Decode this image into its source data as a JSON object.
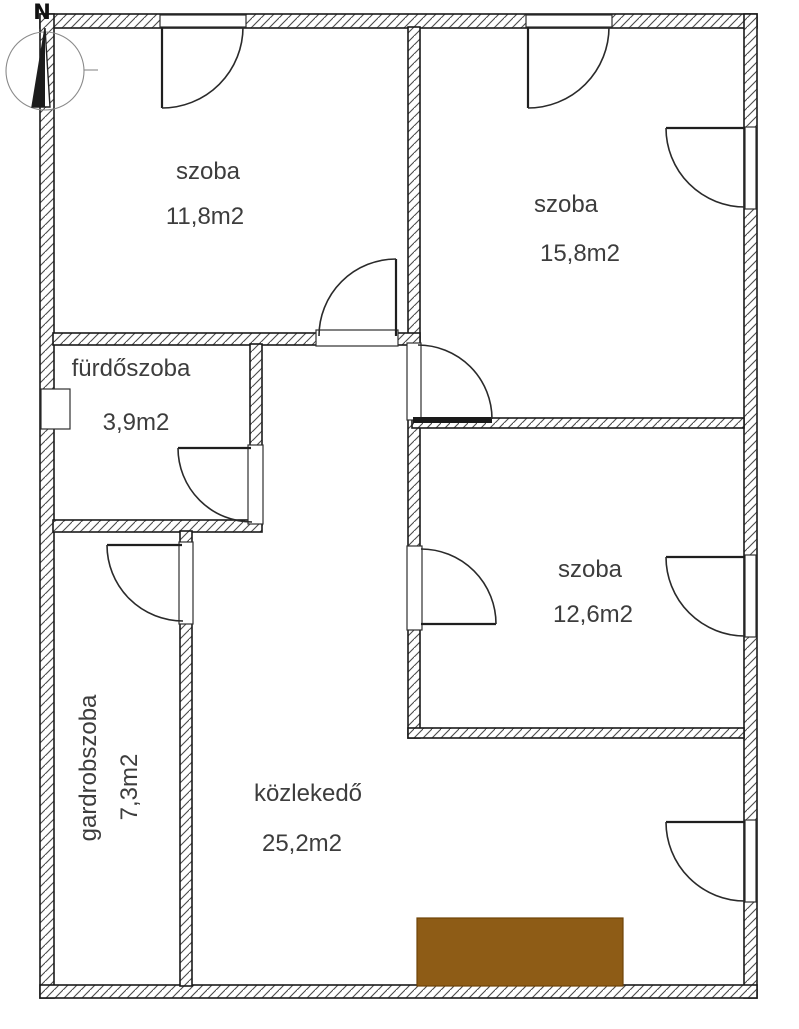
{
  "plan": {
    "compass": {
      "north_label": "N"
    },
    "rooms": [
      {
        "name": "szoba",
        "area": "11,8m2"
      },
      {
        "name": "szoba",
        "area": "15,8m2"
      },
      {
        "name": "fürdőszoba",
        "area": "3,9m2"
      },
      {
        "name": "szoba",
        "area": "12,6m2"
      },
      {
        "name": "gardrobszoba",
        "area": "7,3m2"
      },
      {
        "name": "közlekedő",
        "area": "25,2m2"
      }
    ],
    "colors": {
      "mat_fill": "#8e5c16",
      "wall_line": "#1a1a1a",
      "label_text": "#3d3d3d"
    }
  }
}
